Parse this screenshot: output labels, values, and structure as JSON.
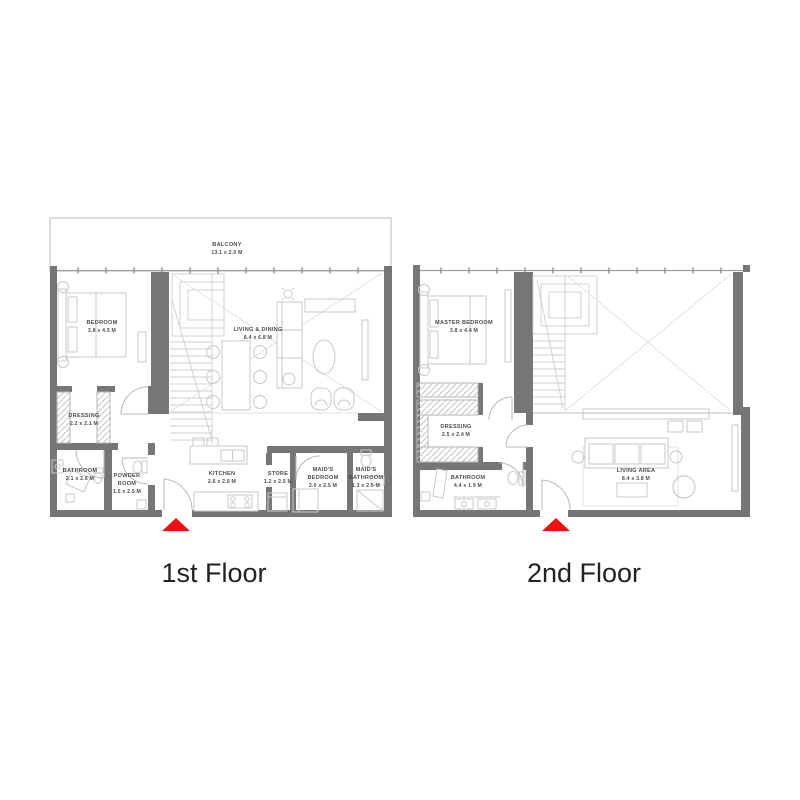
{
  "page": {
    "background": "#ffffff"
  },
  "colors": {
    "wall_gray": "#767676",
    "furniture_gray": "#c9c9c9",
    "label_gray": "#4d4d4d",
    "entry_red": "#ee1111",
    "title_black": "#222222"
  },
  "entry_arrow": {
    "icon": "triangle-up",
    "color": "#ee1111"
  },
  "floors": [
    {
      "title": "1st Floor",
      "rooms": [
        {
          "id": "balcony",
          "lines": [
            "BALCONY",
            "13.1 x 2.0 M"
          ]
        },
        {
          "id": "bedroom",
          "lines": [
            "BEDROOM",
            "3.8 x 4.5 M"
          ]
        },
        {
          "id": "living-dining",
          "lines": [
            "LIVING & DINING",
            "8.4 x 6.8 M"
          ]
        },
        {
          "id": "dressing",
          "lines": [
            "DRESSING",
            "2.2 x 2.1 M"
          ]
        },
        {
          "id": "bathroom",
          "lines": [
            "BATHROOM",
            "2.1 x 2.6 M"
          ]
        },
        {
          "id": "powder-room",
          "lines": [
            "POWDER",
            "ROOM",
            "1.5 x 2.5 M"
          ]
        },
        {
          "id": "kitchen",
          "lines": [
            "KITCHEN",
            "2.6 x 2.6 M"
          ]
        },
        {
          "id": "store",
          "lines": [
            "STORE",
            "1.2 x 2.5 M"
          ]
        },
        {
          "id": "maids-bedroom",
          "lines": [
            "MAID'S",
            "BEDROOM",
            "2.0 x 2.5 M"
          ]
        },
        {
          "id": "maids-bathroom",
          "lines": [
            "MAID'S",
            "BATHROOM",
            "1.3 x 2.5 M"
          ]
        }
      ]
    },
    {
      "title": "2nd Floor",
      "rooms": [
        {
          "id": "master-bedroom",
          "lines": [
            "MASTER BEDROOM",
            "3.8 x 4.4 M"
          ]
        },
        {
          "id": "dressing",
          "lines": [
            "DRESSING",
            "2.5 x 2.4 M"
          ]
        },
        {
          "id": "bathroom",
          "lines": [
            "BATHROOM",
            "4.4 x 1.9 M"
          ]
        },
        {
          "id": "living-area",
          "lines": [
            "LIVING AREA",
            "8.4 x 3.8 M"
          ]
        }
      ]
    }
  ]
}
